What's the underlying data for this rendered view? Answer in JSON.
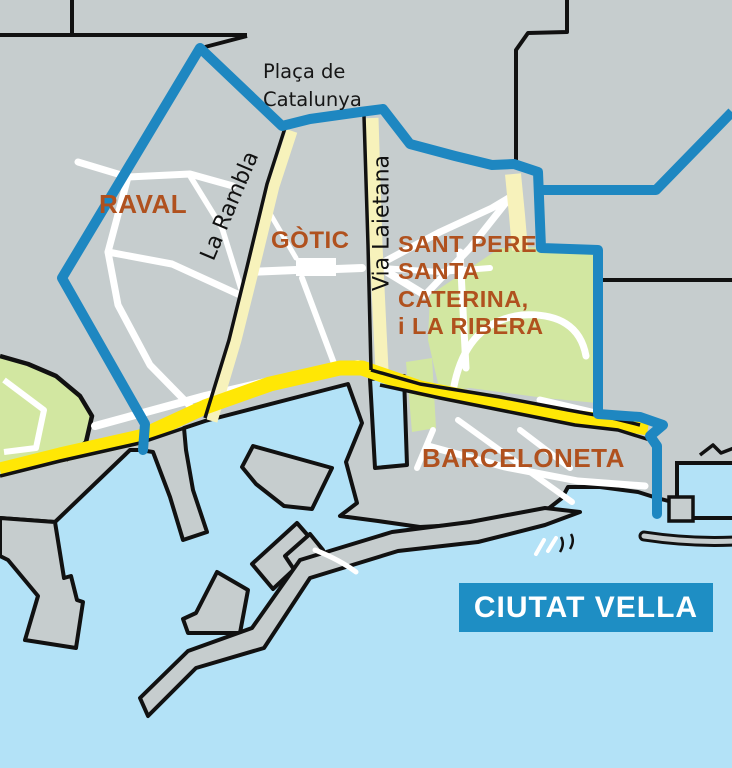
{
  "map": {
    "banner": {
      "label": "CIUTAT VELLA"
    },
    "districts": {
      "raval": "RAVAL",
      "gotic": "GÒTIC",
      "sant_pere": {
        "line1": "SANT PERE",
        "line2": "SANTA",
        "line3": "CATERINA,",
        "line4": "i LA RIBERA"
      },
      "barceloneta": "BARCELONETA"
    },
    "streets": {
      "la_rambla": "La Rambla",
      "via_laietana": "Via Laietana"
    },
    "places": {
      "placa_catalunya": {
        "line1": "Plaça de",
        "line2": "Catalunya"
      }
    },
    "colors": {
      "land": "#c6cdce",
      "sea": "#b3e2f7",
      "park_green": "#d2e7a1",
      "road_yellow": "#ffe705",
      "road_pale": "#f7f2bb",
      "boundary_blue": "#1e87c1",
      "banner_blue": "#1e8ec4",
      "district_label_brown": "#b0511e",
      "outline_black": "#111111",
      "street_white": "#ffffff"
    }
  }
}
